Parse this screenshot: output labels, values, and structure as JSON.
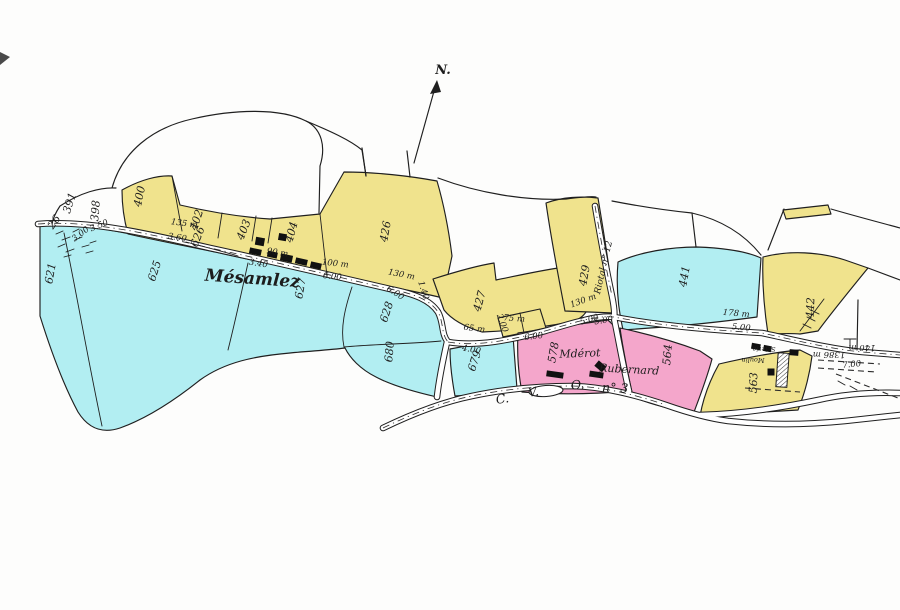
{
  "map": {
    "type": "hand-drawn cadastral parcel map",
    "north_label": "N.",
    "colors": {
      "paper": "#fdfdfc",
      "ink": "#1f1f1f",
      "yellow": "#f0e38d",
      "cyan": "#b2eef2",
      "pink": "#f4a6cb"
    },
    "place_names": [
      "Mésamlez",
      "Mdérot",
      "Rubernard"
    ],
    "road_names": [
      "Riotal n° 12",
      "C. V. O. n° 3"
    ],
    "parcel_numbers": [
      "391",
      "398",
      "400",
      "402",
      "403",
      "404",
      "426",
      "427",
      "429",
      "441",
      "442",
      "563",
      "564",
      "578",
      "621",
      "625",
      "626",
      "627",
      "628",
      "679",
      "680",
      "26"
    ],
    "labels": [
      {
        "text": "391",
        "x": 73,
        "y": 204,
        "rot": -72,
        "cls": "parcel"
      },
      {
        "text": "398",
        "x": 99,
        "y": 211,
        "rot": -85,
        "cls": "parcel",
        "size": 7
      },
      {
        "text": "400",
        "x": 143,
        "y": 197,
        "rot": -78,
        "cls": "parcel"
      },
      {
        "text": "402",
        "x": 200,
        "y": 221,
        "rot": -72,
        "cls": "parcel"
      },
      {
        "text": "403",
        "x": 247,
        "y": 231,
        "rot": -68,
        "cls": "parcel"
      },
      {
        "text": "404",
        "x": 295,
        "y": 233,
        "rot": -75,
        "cls": "parcel"
      },
      {
        "text": "426",
        "x": 389,
        "y": 232,
        "rot": -80,
        "cls": "parcel"
      },
      {
        "text": "427",
        "x": 483,
        "y": 302,
        "rot": -75,
        "cls": "parcel"
      },
      {
        "text": "429",
        "x": 588,
        "y": 276,
        "rot": -80,
        "cls": "parcel"
      },
      {
        "text": "441",
        "x": 688,
        "y": 277,
        "rot": -80,
        "cls": "parcel"
      },
      {
        "text": "442",
        "x": 814,
        "y": 308,
        "rot": -87,
        "cls": "parcel"
      },
      {
        "text": "563",
        "x": 757,
        "y": 383,
        "rot": -87,
        "cls": "parcel"
      },
      {
        "text": "564",
        "x": 671,
        "y": 355,
        "rot": -85,
        "cls": "parcel"
      },
      {
        "text": "578",
        "x": 557,
        "y": 353,
        "rot": -80,
        "cls": "parcel"
      },
      {
        "text": "621",
        "x": 54,
        "y": 274,
        "rot": -80,
        "cls": "parcel"
      },
      {
        "text": "625",
        "x": 158,
        "y": 272,
        "rot": -72,
        "cls": "parcel"
      },
      {
        "text": "626",
        "x": 201,
        "y": 238,
        "rot": -68,
        "cls": "parcel",
        "size": 8
      },
      {
        "text": "627",
        "x": 304,
        "y": 289,
        "rot": -80,
        "cls": "parcel"
      },
      {
        "text": "628",
        "x": 390,
        "y": 313,
        "rot": -72,
        "cls": "parcel"
      },
      {
        "text": "679",
        "x": 478,
        "y": 362,
        "rot": -72,
        "cls": "parcel"
      },
      {
        "text": "680",
        "x": 393,
        "y": 352,
        "rot": -85,
        "cls": "parcel"
      },
      {
        "text": "26",
        "x": 57,
        "y": 224,
        "rot": -55,
        "cls": "parcel",
        "size": 8
      },
      {
        "text": "3.00",
        "x": 82,
        "y": 236,
        "rot": -38,
        "cls": "meas"
      },
      {
        "text": "3.50",
        "x": 100,
        "y": 228,
        "rot": -22,
        "cls": "meas"
      },
      {
        "text": "135 m",
        "x": 184,
        "y": 226,
        "rot": 8,
        "cls": "meas"
      },
      {
        "text": "3.60",
        "x": 177,
        "y": 240,
        "rot": 8,
        "cls": "meas"
      },
      {
        "text": "3.40",
        "x": 258,
        "y": 266,
        "rot": 9,
        "cls": "meas"
      },
      {
        "text": "90 m",
        "x": 277,
        "y": 255,
        "rot": 9,
        "cls": "meas"
      },
      {
        "text": "100 m",
        "x": 335,
        "y": 266,
        "rot": 6,
        "cls": "meas"
      },
      {
        "text": "6.00",
        "x": 332,
        "y": 279,
        "rot": 6,
        "cls": "meas"
      },
      {
        "text": "130 m",
        "x": 401,
        "y": 277,
        "rot": 11,
        "cls": "meas"
      },
      {
        "text": "6.00",
        "x": 394,
        "y": 295,
        "rot": 33,
        "cls": "meas"
      },
      {
        "text": "1.40",
        "x": 421,
        "y": 291,
        "rot": 72,
        "cls": "meas"
      },
      {
        "text": "65 m",
        "x": 474,
        "y": 331,
        "rot": 7,
        "cls": "meas"
      },
      {
        "text": "4.00",
        "x": 471,
        "y": 352,
        "rot": 10,
        "cls": "meas"
      },
      {
        "text": "2.00",
        "x": 500,
        "y": 324,
        "rot": 70,
        "cls": "meas",
        "size": 7
      },
      {
        "text": "75 m",
        "x": 514,
        "y": 321,
        "rot": 4,
        "cls": "meas",
        "size": 7
      },
      {
        "text": "6.00",
        "x": 534,
        "y": 339,
        "rot": -7,
        "cls": "meas"
      },
      {
        "text": "5.00",
        "x": 604,
        "y": 323,
        "rot": -9,
        "cls": "meas"
      },
      {
        "text": "130 m",
        "x": 584,
        "y": 303,
        "rot": -20,
        "cls": "meas"
      },
      {
        "text": "5.00",
        "x": 590,
        "y": 322,
        "rot": -16,
        "cls": "meas"
      },
      {
        "text": "178 m",
        "x": 736,
        "y": 316,
        "rot": 5,
        "cls": "meas"
      },
      {
        "text": "5.00",
        "x": 741,
        "y": 330,
        "rot": 5,
        "cls": "meas"
      },
      {
        "text": "7.00",
        "x": 852,
        "y": 367,
        "rot": -6,
        "cls": "meas"
      },
      {
        "text": "1386 m",
        "x": 829,
        "y": 352,
        "rot": 180,
        "cls": "meas",
        "size": 7.5
      },
      {
        "text": "140 m",
        "x": 862,
        "y": 345,
        "rot": 180,
        "cls": "meas",
        "size": 7.5
      },
      {
        "text": "Mésamlez",
        "x": 252,
        "y": 284,
        "rot": 4,
        "cls": "place-big"
      },
      {
        "text": "Mdérot",
        "x": 580,
        "y": 357,
        "rot": -2,
        "cls": "place"
      },
      {
        "text": "Rubernard",
        "x": 629,
        "y": 373,
        "rot": 3,
        "cls": "place"
      },
      {
        "text": "Scierie",
        "x": 764,
        "y": 347,
        "rot": 180,
        "cls": "tiny"
      },
      {
        "text": "Moulin",
        "x": 753,
        "y": 358,
        "rot": 180,
        "cls": "tiny"
      },
      {
        "text": "Riotal n° 12",
        "x": 606,
        "y": 268,
        "rot": -77,
        "cls": "roadlab"
      },
      {
        "text": "C.",
        "x": 503,
        "y": 403,
        "rot": -8,
        "cls": "roadname"
      },
      {
        "text": "V.",
        "x": 534,
        "y": 396,
        "rot": -8,
        "cls": "roadname"
      },
      {
        "text": "O.",
        "x": 578,
        "y": 389,
        "rot": -5,
        "cls": "roadname"
      },
      {
        "text": "n° 3",
        "x": 615,
        "y": 392,
        "rot": 3,
        "cls": "roadname"
      }
    ]
  }
}
